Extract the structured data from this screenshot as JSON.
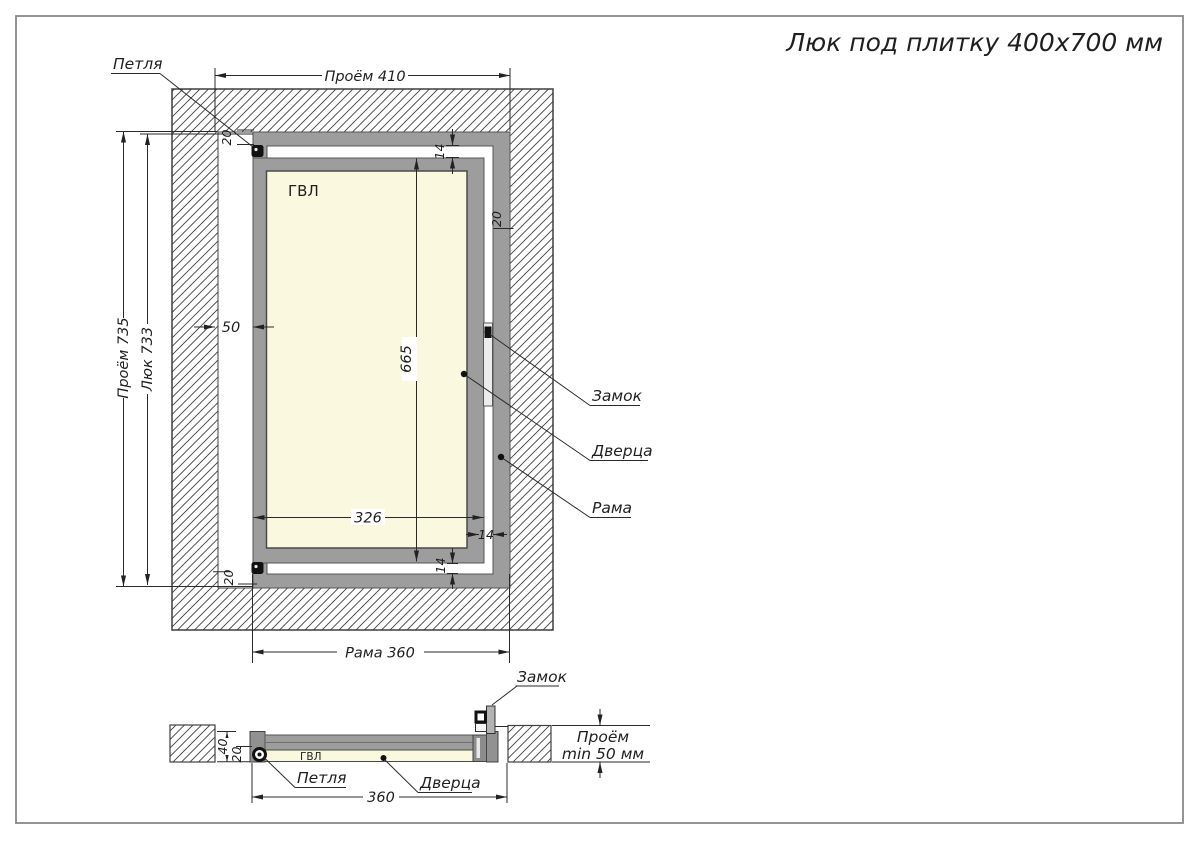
{
  "title": "Люк под плитку 400x700 мм",
  "plan": {
    "dims": {
      "opening_width": "Проём 410",
      "opening_height": "Проём 735",
      "hatch_height": "Люк 733",
      "hinge_gap": "50",
      "door_height": "665",
      "door_width": "326",
      "clearance_top": "14",
      "clearance_bottom": "14",
      "clearance_side": "14",
      "frame_profile_top": "20",
      "frame_profile_right": "20",
      "frame_profile_bottom": "20",
      "frame_width": "Рама 360"
    },
    "labels": {
      "hinge": "Петля",
      "lock": "Замок",
      "door": "Дверца",
      "frame": "Рама",
      "panel": "ГВЛ"
    }
  },
  "section": {
    "dims": {
      "frame_depth": "40",
      "panel_depth": "20",
      "frame_width": "360",
      "opening_depth_line1": "Проём",
      "opening_depth_line2": "min 50 мм"
    },
    "labels": {
      "lock": "Замок",
      "hinge": "Петля",
      "door": "Дверца",
      "panel": "ГВЛ"
    }
  },
  "colors": {
    "frame_gray": "#9d9d9d",
    "profile_gray": "#919191",
    "panel_cream": "#fbf8e0",
    "hatch_line": "#454545",
    "line": "#2a2a2a",
    "text": "#1f1f1f"
  }
}
